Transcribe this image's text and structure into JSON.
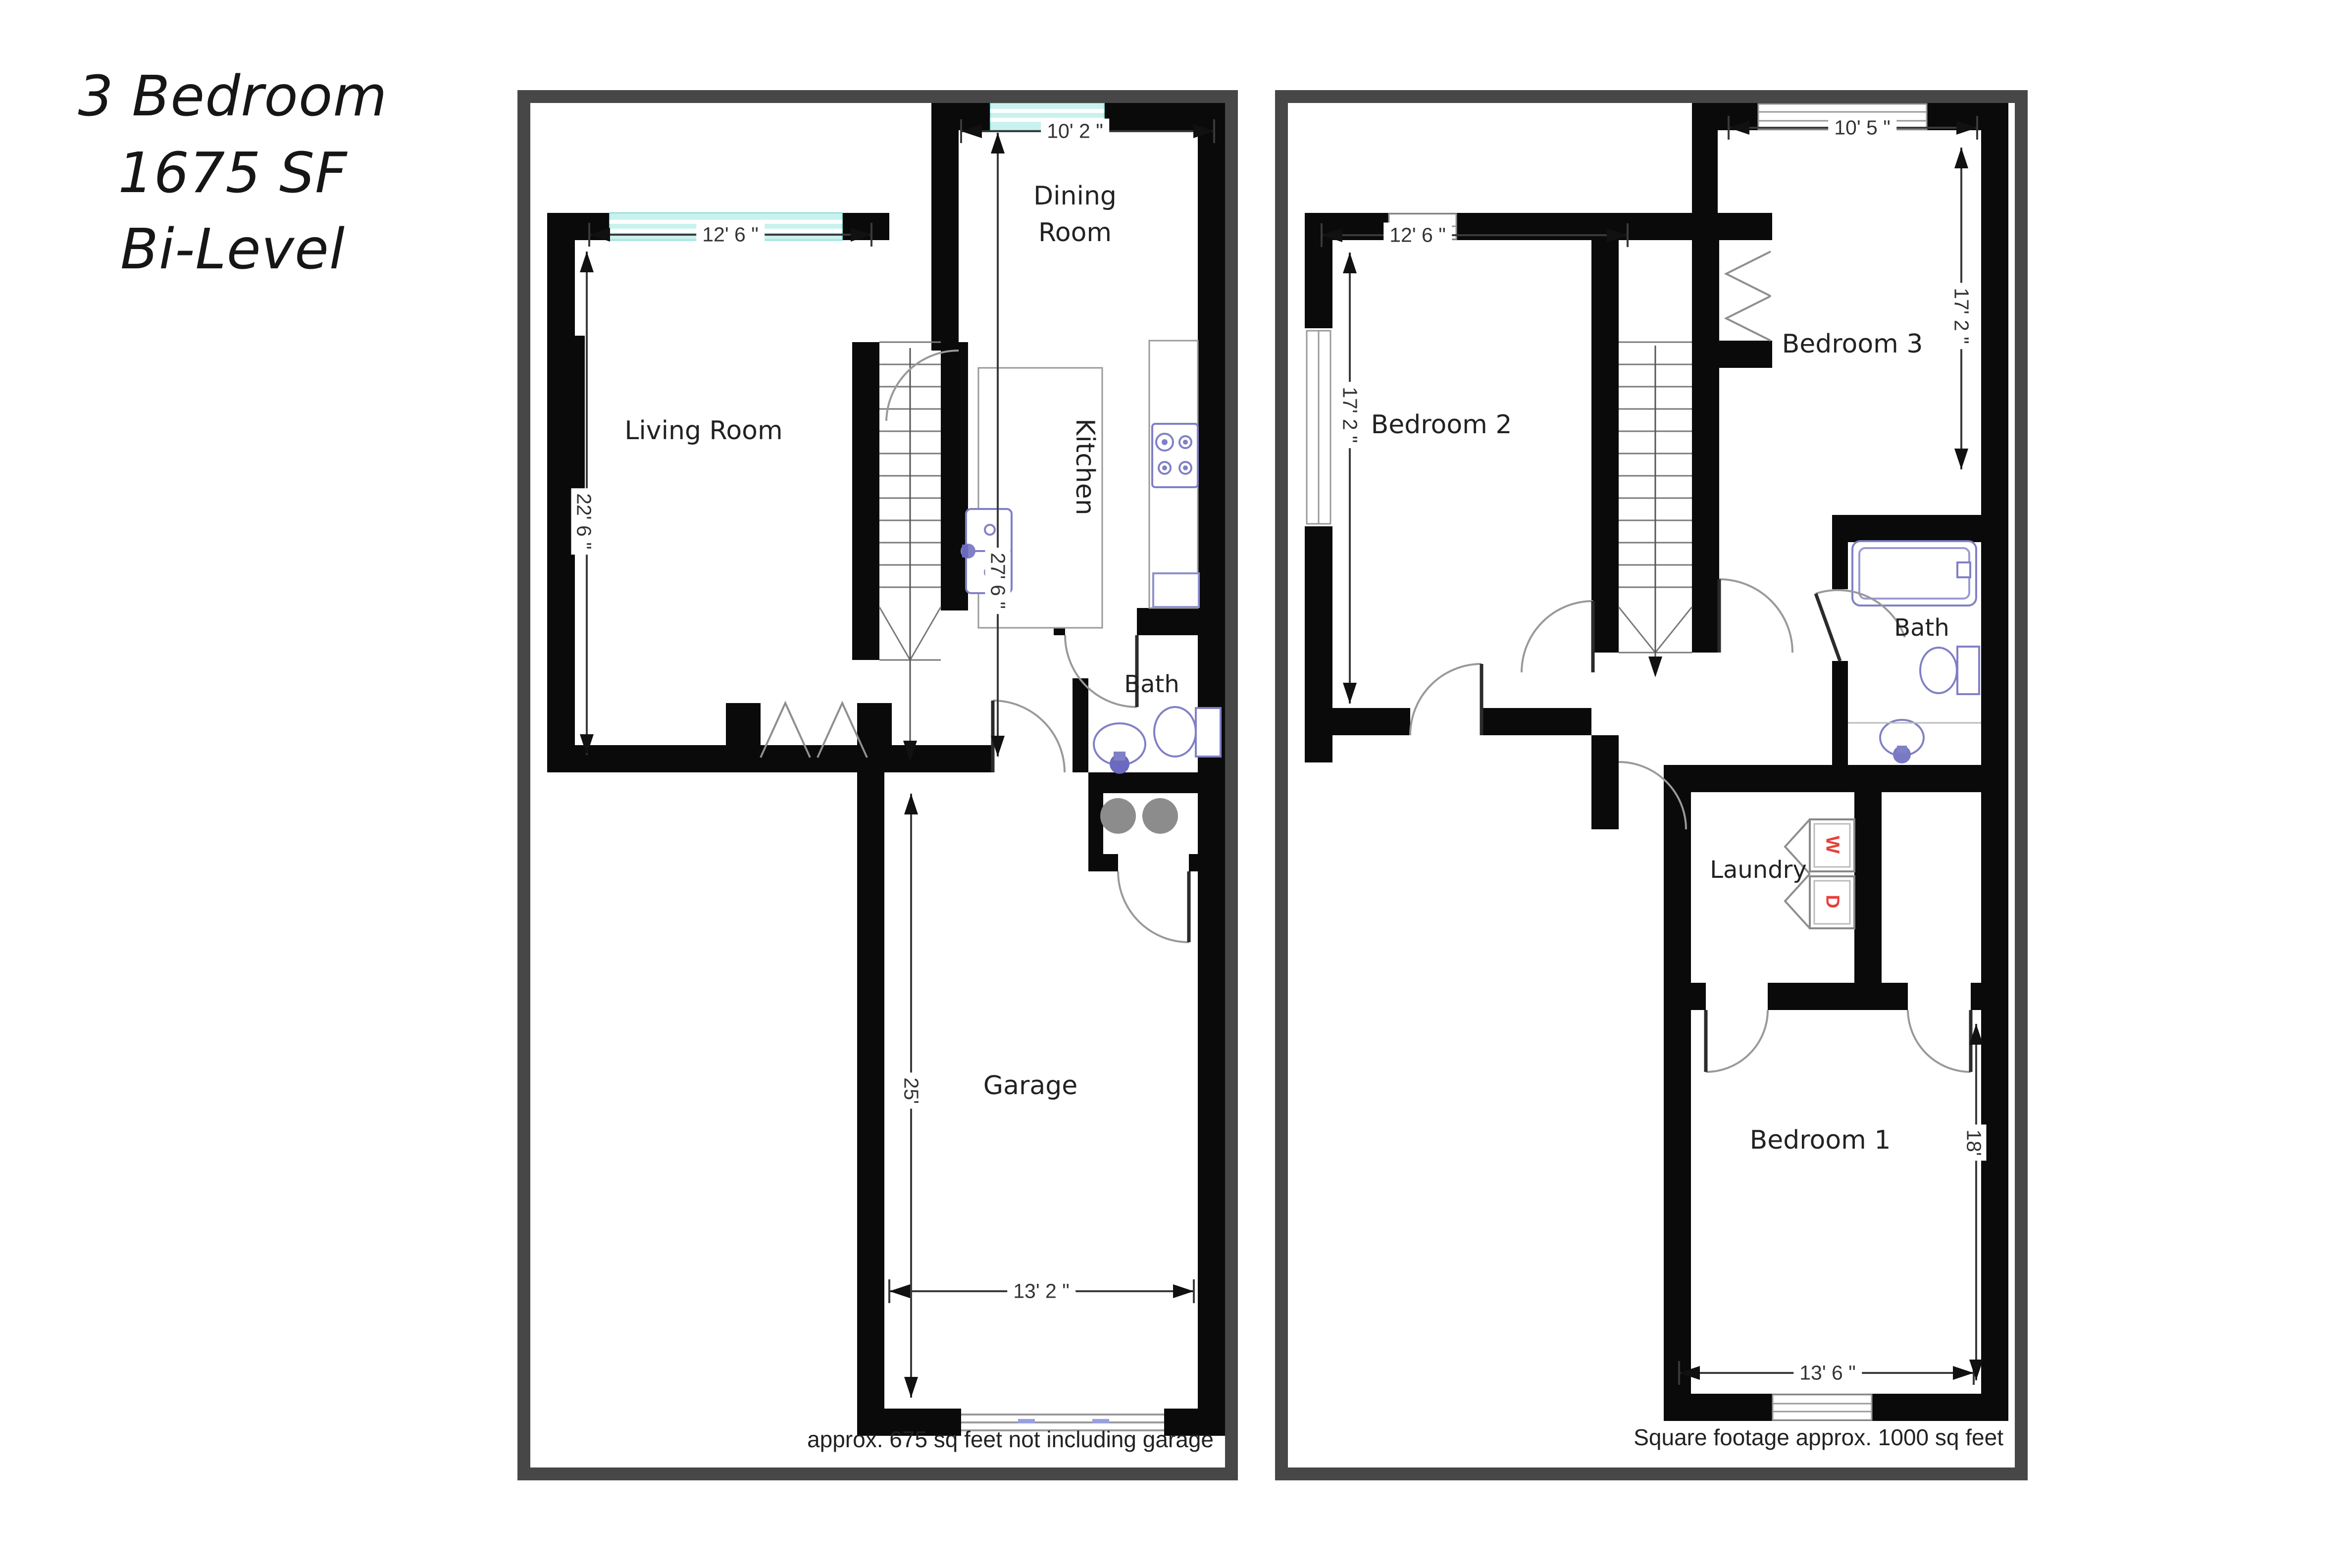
{
  "title": {
    "line1": "3 Bedroom",
    "line2": "1675 SF",
    "line3": "Bi-Level"
  },
  "left_plan": {
    "rooms": {
      "living": {
        "label": "Living Room",
        "width_dim": "12' 6 \"",
        "depth_dim": "22' 6 \""
      },
      "dining": {
        "label_line1": "Dining",
        "label_line2": "Room",
        "width_dim": "10' 2 \""
      },
      "kitchen": {
        "label": "Kitchen",
        "depth_dim": "27' 6 \""
      },
      "bath": {
        "label": "Bath"
      },
      "garage": {
        "label": "Garage",
        "depth_dim": "25'",
        "width_dim": "13' 2 \""
      }
    },
    "footnote": "approx. 675 sq feet not including garage"
  },
  "right_plan": {
    "rooms": {
      "bedroom2": {
        "label": "Bedroom 2",
        "width_dim": "12' 6 \"",
        "depth_dim": "17' 2 \""
      },
      "bedroom3": {
        "label": "Bedroom 3",
        "width_dim": "10' 5 \"",
        "depth_dim": "17' 2 \""
      },
      "bath": {
        "label": "Bath"
      },
      "laundry": {
        "label": "Laundry",
        "washer": "W",
        "dryer": "D"
      },
      "bedroom1": {
        "label": "Bedroom 1",
        "depth_dim": "18'",
        "width_dim": "13' 6 \""
      }
    },
    "footnote": "Square footage approx. 1000 sq feet"
  },
  "colors": {
    "wall": "#0a0a0a",
    "panel_border": "#474747",
    "window_glass": "#c9f2ee",
    "fixture": "#8080c6",
    "dimension": "#3a3a3a",
    "laundry_letter": "#e8403a",
    "post_gray": "#8c8c8c",
    "door_arc": "#999999"
  }
}
